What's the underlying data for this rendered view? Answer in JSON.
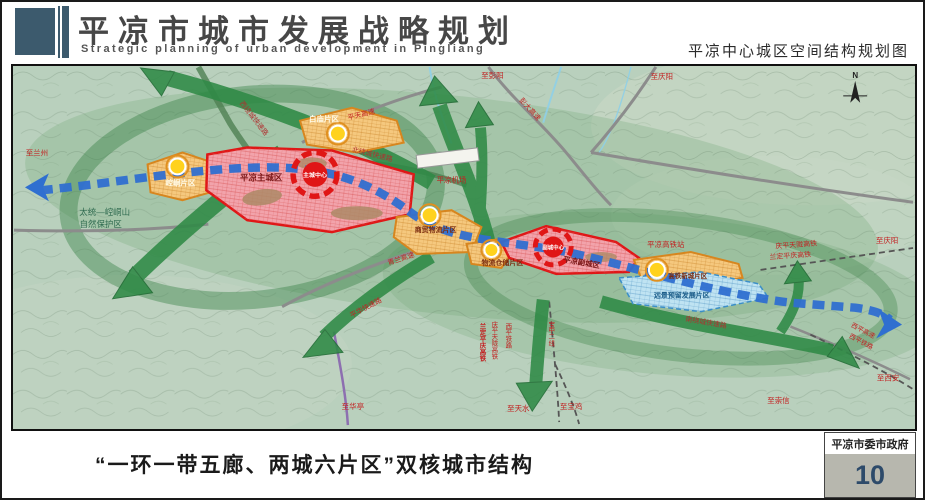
{
  "header": {
    "title": "平凉市城市发展战略规划",
    "subtitle_en": "Strategic planning of urban development in Pingliang",
    "map_title": "平凉中心城区空间结构规划图"
  },
  "map": {
    "compass": "N",
    "zones": {
      "baimiao": "白庙片区",
      "kongtong": "崆峒片区",
      "main_city": "平凉主城区",
      "main_center": "主城中心",
      "trade_logistics": "商贸物流片区",
      "warehouse": "物流仓储片区",
      "sub_city": "平凉副城区",
      "sub_center": "副城中心",
      "hsr_newtown": "高铁新城片区",
      "reserved": "远景预留发展片区"
    },
    "places": {
      "airport": "平凉机场",
      "hsr_station": "平凉高铁站",
      "nature_reserve_line1": "太统—崆峒山",
      "nature_reserve_line2": "自然保护区"
    },
    "roads": {
      "west_ring": "西绕城快速路",
      "north_ring": "北绕城快速路",
      "south_ring": "南绕城快速路",
      "pingtian_expwy": "平天高速",
      "pengda_expwy": "彭大高速",
      "qinglan_expwy": "青兰高速",
      "pinghua_expwy": "平华快速路",
      "qingping_hsr": "庆平天陇高铁",
      "landing_hsr": "兰定平庆高铁",
      "xiping_rail": "西平铁路",
      "xiping_expwy": "西平高速",
      "baozhong_line2": "宝中二线"
    },
    "directions": {
      "to_lanzhou": "至兰州",
      "to_pengyang": "至彭阳",
      "to_qingyang_top": "至庆阳",
      "to_qingyang_right": "至庆阳",
      "to_xian": "至西安",
      "to_chongxin": "至崇信",
      "to_huating": "至华亭",
      "to_tianshui": "至天水",
      "to_baoji": "至宝鸡"
    },
    "colors": {
      "corridor_green": "#2f8a46",
      "axis_blue": "#2f6fd0",
      "zone_orange": "#f5c87e",
      "city_red": "#e01616",
      "reserved_blue": "#bfe3f2"
    }
  },
  "footer": {
    "caption": "“一环一带五廊、两城六片区”双核城市结构",
    "org": "平凉市委市政府",
    "page": "10"
  }
}
